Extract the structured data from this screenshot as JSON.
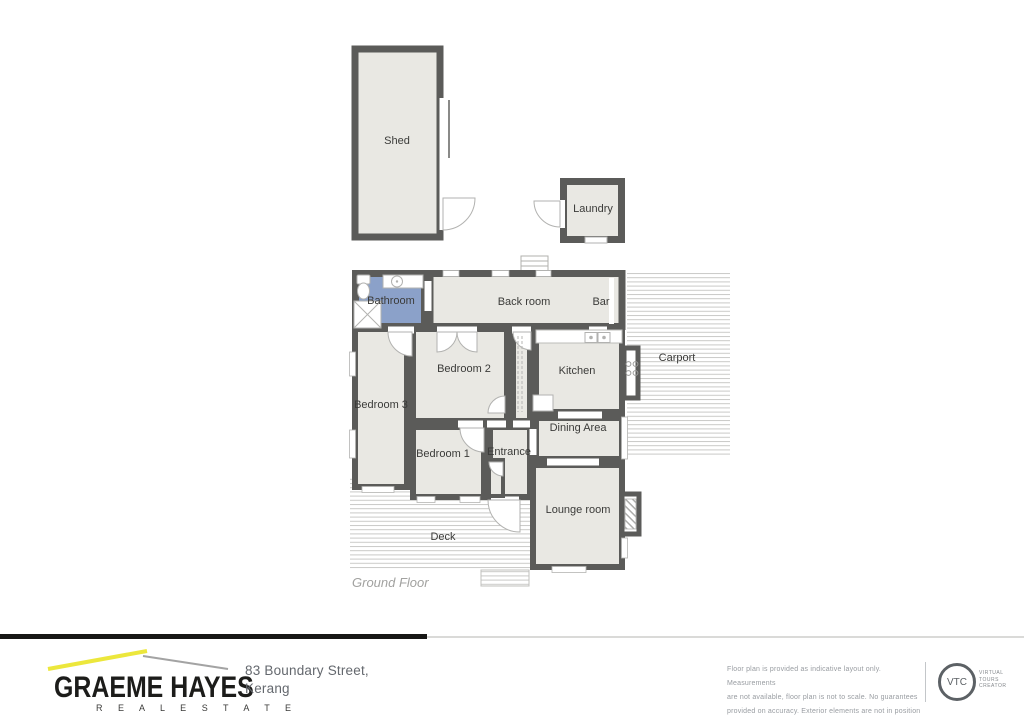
{
  "plan": {
    "floor_label": "Ground Floor",
    "rooms": {
      "shed": "Shed",
      "laundry": "Laundry",
      "bathroom": "Bathroom",
      "back_room": "Back room",
      "bar": "Bar",
      "carport": "Carport",
      "bedroom2": "Bedroom 2",
      "kitchen": "Kitchen",
      "bedroom3": "Bedroom 3",
      "dining": "Dining Area",
      "bedroom1": "Bedroom 1",
      "entrance": "Entrance",
      "lounge": "Lounge room",
      "deck": "Deck"
    },
    "colors": {
      "wall": "#5b5b59",
      "room_fill": "#e9e8e3",
      "bathroom_fill": "#8ba1c9",
      "stripe": "#c9c9c7"
    }
  },
  "footer": {
    "brand": {
      "name": "GRAEME HAYES",
      "tagline": "R E A L   E S T A T E",
      "accent_color": "#ece73c"
    },
    "address_line1": "83 Boundary Street,",
    "address_line2": "Kerang",
    "disclaimer_line1": "Floor plan is provided as indicative layout only. Measurements",
    "disclaimer_line2": "are not available, floor plan is not to scale. No guarantees",
    "disclaimer_line3": "provided on accuracy. Exterior elements are not in position",
    "vtc": {
      "badge": "VTC",
      "label_line1": "VIRTUAL",
      "label_line2": "TOURS",
      "label_line3": "CREATOR"
    }
  }
}
